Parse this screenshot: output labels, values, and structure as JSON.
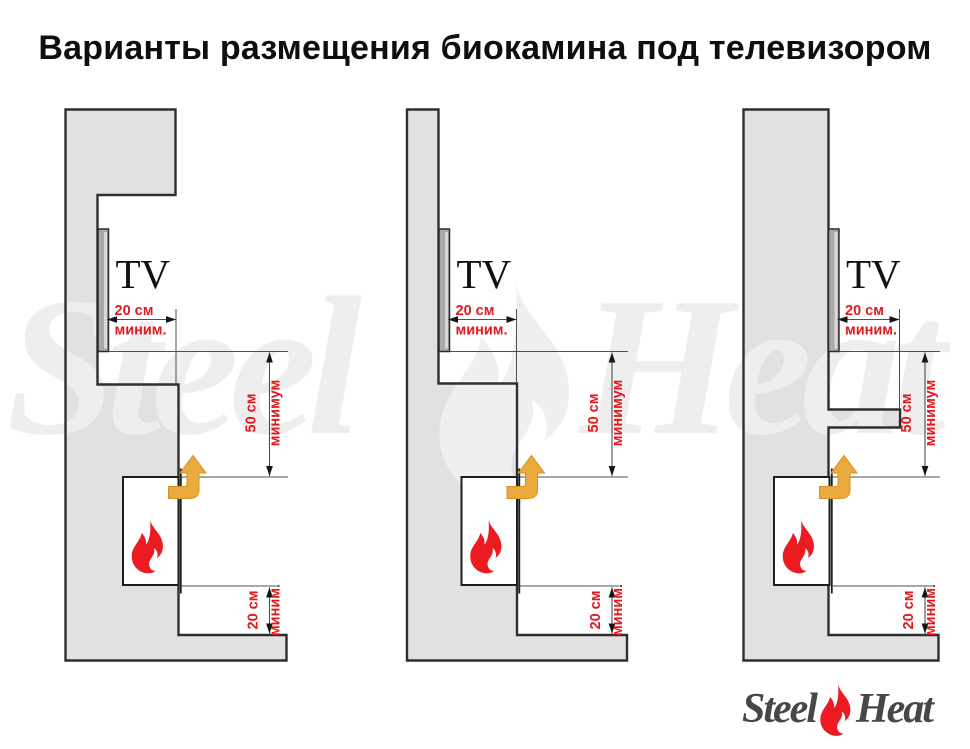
{
  "title": "Варианты размещения биокамина под телевизором",
  "labels": {
    "tv": "TV",
    "front_clearance_value": "20 см",
    "front_clearance_unit": "миним.",
    "above_clearance_value": "50 см",
    "above_clearance_unit": "минимум",
    "below_clearance_value": "20 см",
    "below_clearance_unit": "миним."
  },
  "watermark": {
    "word_left": "Steel",
    "word_right": "Heat"
  },
  "logo": {
    "word_left": "Steel",
    "word_right": "Heat"
  },
  "colors": {
    "accent_red": "#e2191f",
    "wall_fill": "#e1e1e1",
    "wall_stroke": "#2f2f2f",
    "line_gray": "#4f4f4f",
    "arrow_orange": "#ebaa3e",
    "arrow_orange_edge": "#d3921f",
    "flame_red": "#ec1b22",
    "tv_gray": "#a9a9a9",
    "watermark_gray": "#efefef",
    "logo_text": "#474747"
  }
}
